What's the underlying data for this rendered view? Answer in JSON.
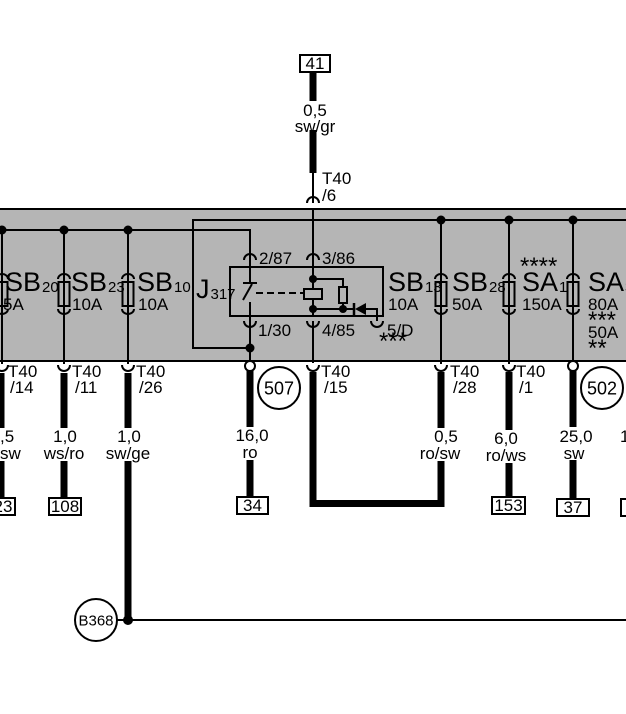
{
  "colors": {
    "panel_gray": "#b5b5b5",
    "line_black": "#000000"
  },
  "top_branch": {
    "target_box": "41",
    "gauge": "0,5",
    "color": "sw/gr",
    "connector": "T40",
    "pin": "/6"
  },
  "fuses_left": [
    {
      "id": "SB",
      "sub": "20",
      "rating": "5A"
    },
    {
      "id": "SB",
      "sub": "23",
      "rating": "10A"
    },
    {
      "id": "SB",
      "sub": "10",
      "rating": "10A"
    }
  ],
  "relay": {
    "id": "J",
    "sub": "317",
    "pins": {
      "top_left": "2/87",
      "top_right": "3/86",
      "bottom_left": "1/30",
      "bottom_mid": "4/85",
      "bottom_right": "5/D"
    },
    "footnote": "***"
  },
  "fuses_right": [
    {
      "id": "SB",
      "sub": "13",
      "rating": "10A"
    },
    {
      "id": "SB",
      "sub": "28",
      "rating": "50A"
    },
    {
      "id": "SA",
      "sub": "1",
      "rating": "150A",
      "note_above": "****"
    },
    {
      "id": "SA",
      "sub": "3",
      "rating": "80A",
      "note": "***",
      "rating_alt": "50A",
      "note_alt": "**"
    }
  ],
  "terminals": {
    "t14": {
      "connector": "T40",
      "pin": "/14",
      "gauge": ",5",
      "color": "sw",
      "target": "23"
    },
    "t11": {
      "connector": "T40",
      "pin": "/11",
      "gauge": "1,0",
      "color": "ws/ro",
      "target": "108"
    },
    "t26": {
      "connector": "T40",
      "pin": "/26",
      "gauge": "1,0",
      "color": "sw/ge"
    },
    "p507": {
      "label": "507",
      "gauge": "16,0",
      "color": "ro",
      "target": "34"
    },
    "t15": {
      "connector": "T40",
      "pin": "/15"
    },
    "t28": {
      "connector": "T40",
      "pin": "/28",
      "gauge": "0,5",
      "color": "ro/sw"
    },
    "t1": {
      "connector": "T40",
      "pin": "/1",
      "gauge": "6,0",
      "color": "ro/ws",
      "target": "153"
    },
    "p502": {
      "label": "502",
      "gauge": "25,0",
      "color": "sw",
      "target": "37"
    },
    "edge": {
      "gauge_partial": "1"
    }
  },
  "ground": {
    "label": "B368"
  }
}
